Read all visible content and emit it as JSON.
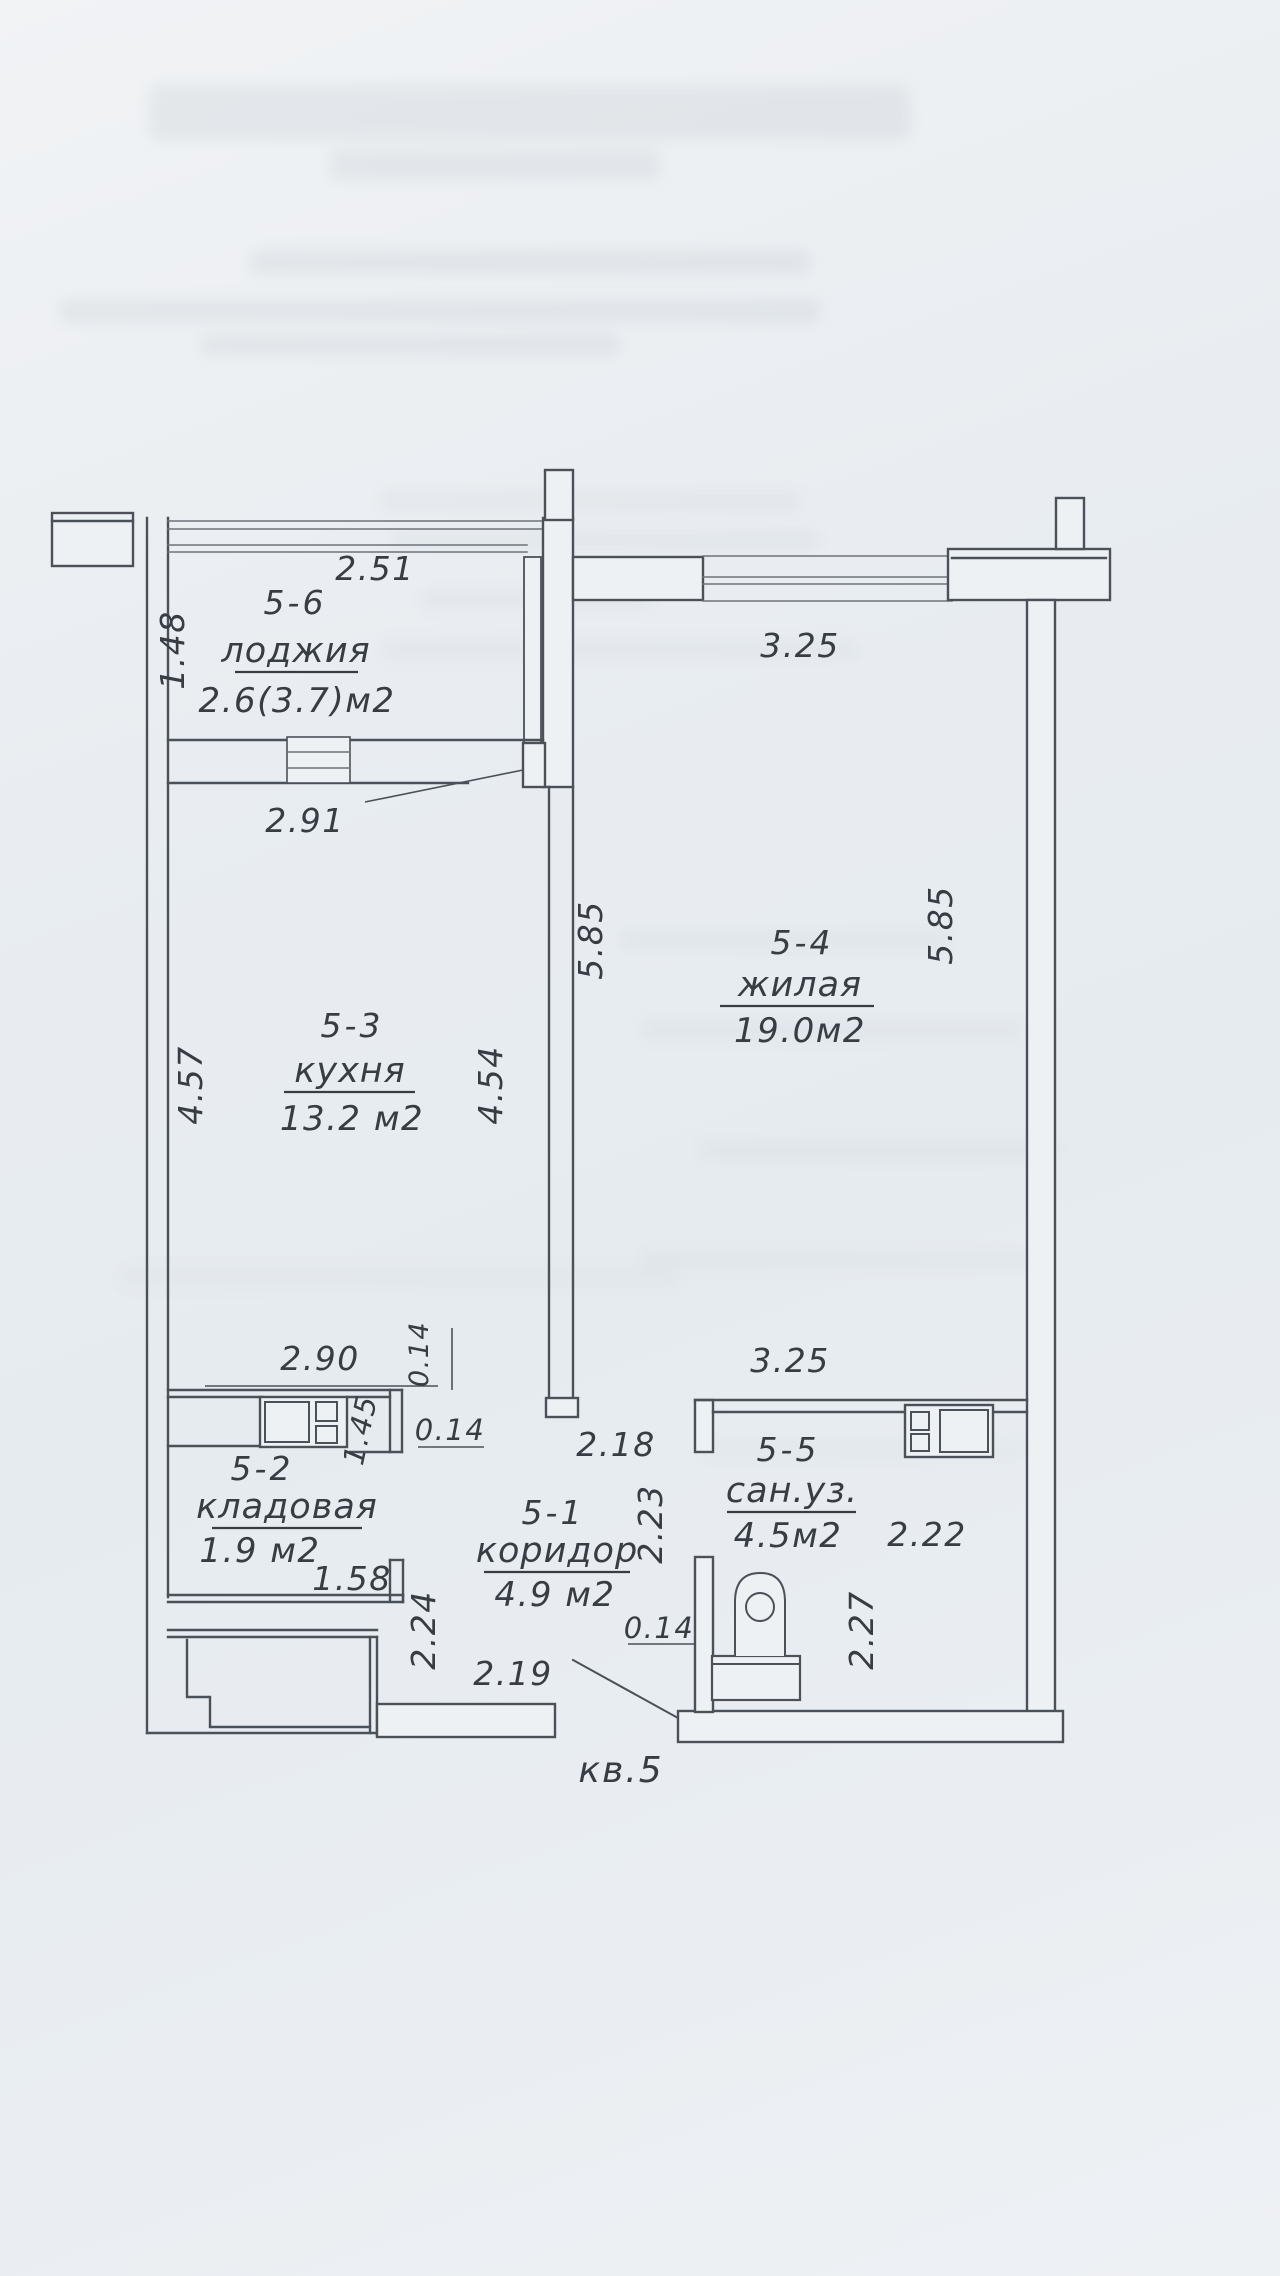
{
  "document": {
    "apartment": "кв.5"
  },
  "rooms": {
    "r56": {
      "num": "5-6",
      "name": "лоджия",
      "area": "2.6(3.7)м2"
    },
    "r53": {
      "num": "5-3",
      "name": "кухня",
      "area": "13.2 м2"
    },
    "r54": {
      "num": "5-4",
      "name": "жилая",
      "area": "19.0м2"
    },
    "r52": {
      "num": "5-2",
      "name": "кладовая",
      "area": "1.9 м2"
    },
    "r51": {
      "num": "5-1",
      "name": "коридор",
      "area": "4.9 м2"
    },
    "r55": {
      "num": "5-5",
      "name": "сан.уз.",
      "area": "4.5м2"
    }
  },
  "dims": {
    "loggia_front": "2.51",
    "loggia_depth": "1.48",
    "loggia_width": "2.91",
    "living_width": "3.25",
    "living_height_left": "5.85",
    "living_height_right": "5.85",
    "kitchen_height_left": "4.57",
    "kitchen_height_right": "4.54",
    "kitchen_width": "2.90",
    "wall_top": "0.14",
    "wall_mid": "0.14",
    "pantry_door": "1.45",
    "pantry_width": "1.58",
    "entry_depth": "2.24",
    "entry_width": "2.19",
    "corridor_width": "2.18",
    "corridor_depth": "2.23",
    "bath_wall": "0.14",
    "bath_width": "3.25",
    "bath_depth_right": "2.22",
    "bath_height": "2.27"
  },
  "colors": {
    "paper": "#e9edf1",
    "wall_line": "#4b5158",
    "thin_line": "#6d737a",
    "text": "#383d44"
  }
}
